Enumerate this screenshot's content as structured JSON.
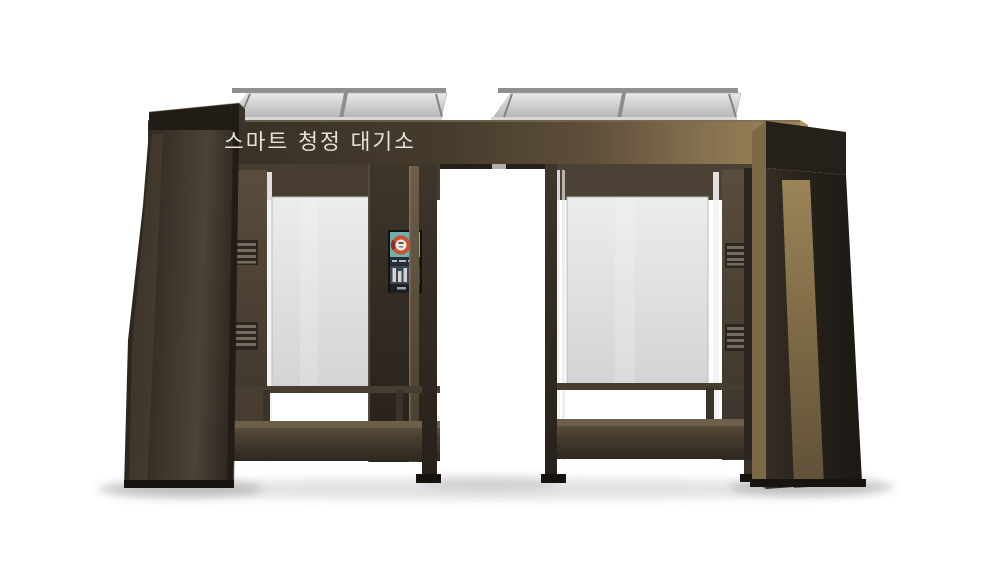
{
  "scene": {
    "subject": "smart clean-air shelter front-view 3D render",
    "background_color": "#ffffff"
  },
  "sign": {
    "text": "스마트 청정 대기소",
    "text_color": "#e3e1da",
    "band_color_left": "#352d24",
    "band_color_right": "#a08655"
  },
  "display_panel": {
    "name": "air-quality-display",
    "screen_color": "#6fb0ac",
    "gauge_ring_color": "#c9512e",
    "bar_color": "#d2d2d2"
  },
  "materials": {
    "frame_dark": "#2b241d",
    "frame_mid": "#463d30",
    "bronze_accent": "#8a7450",
    "glass_light": "#e0e0e2",
    "glass_tint": "#4e4334",
    "roof_panel": "#c7c7c8",
    "foot_black": "#16130f",
    "shadow_gray": "#9b9b9b"
  }
}
